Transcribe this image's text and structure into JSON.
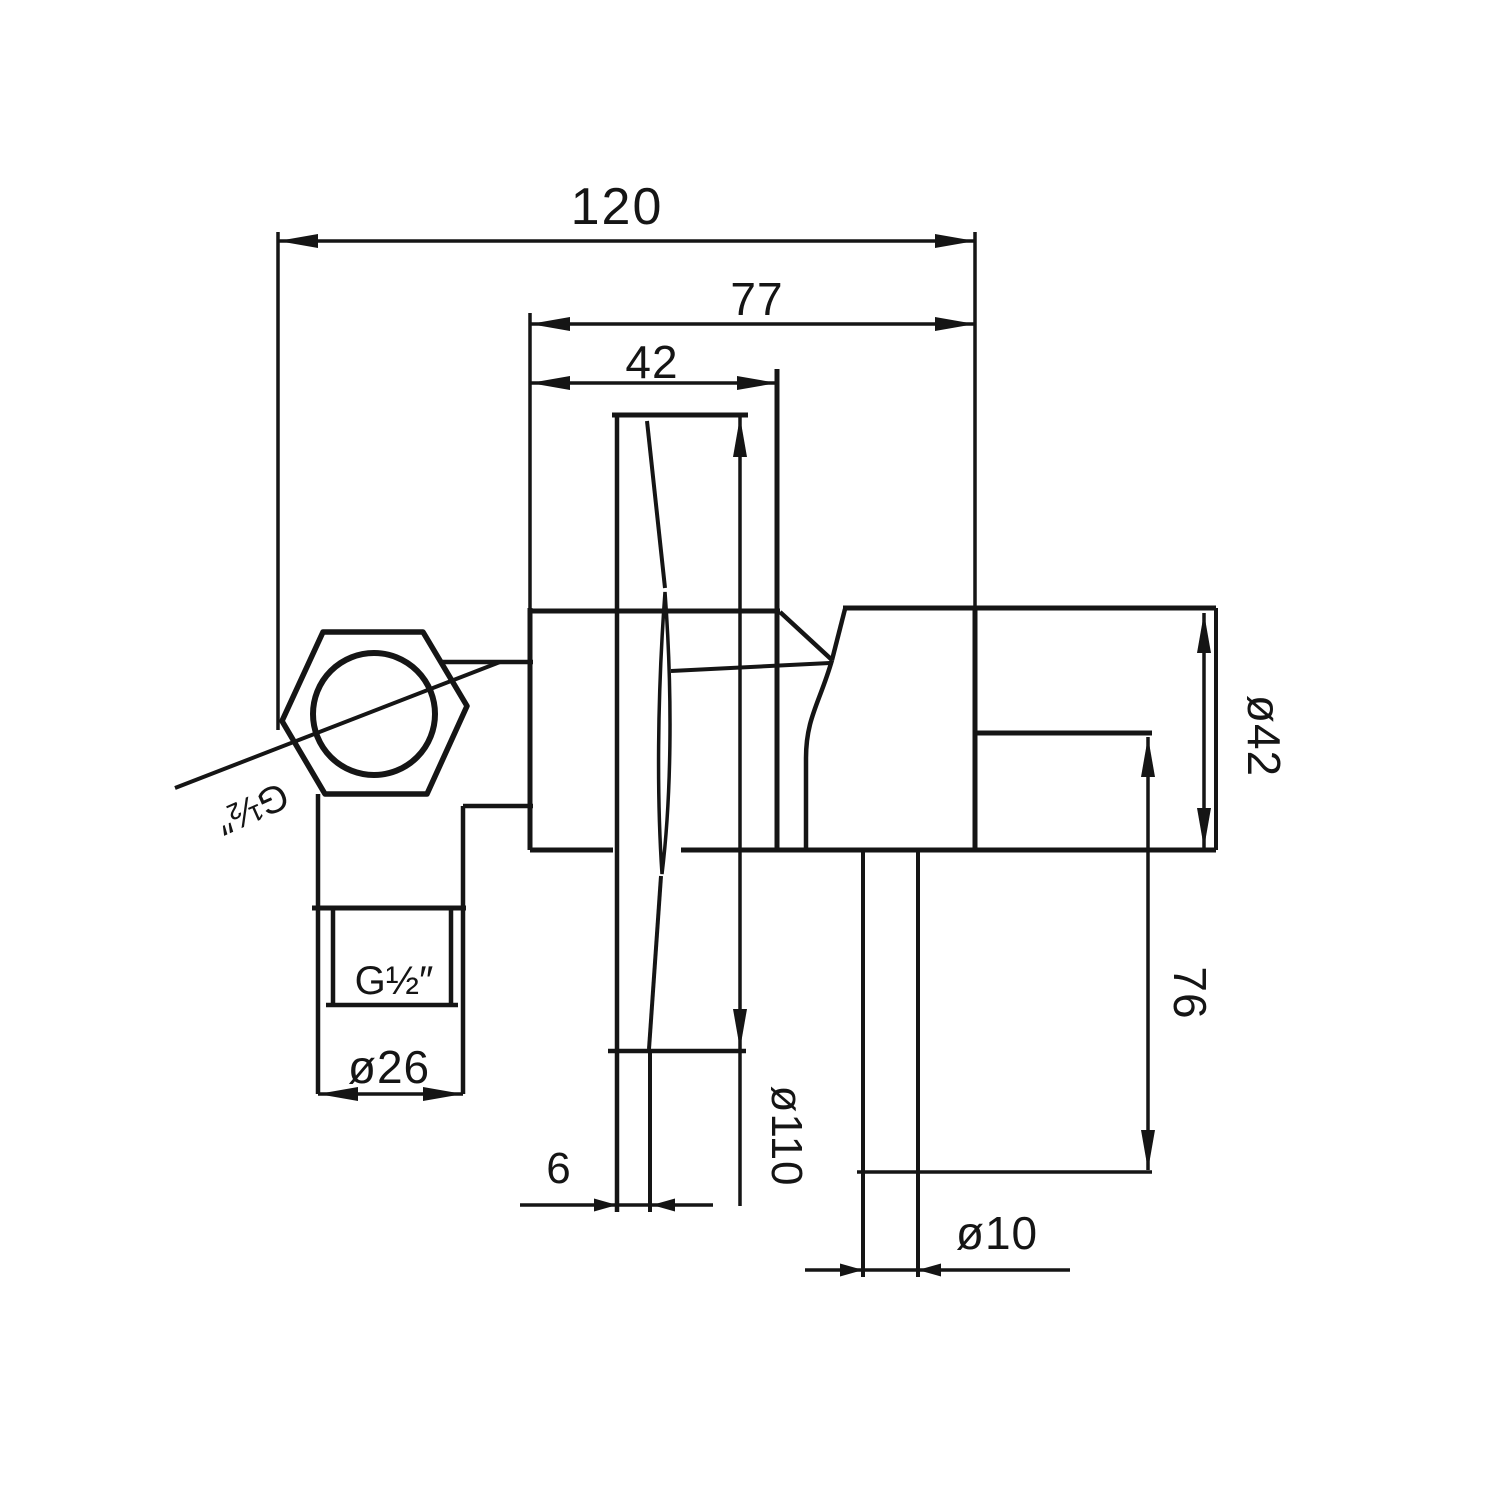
{
  "canvas": {
    "width": 1500,
    "height": 1500,
    "background": "#ffffff",
    "ink": "#151515"
  },
  "drawing": {
    "kind": "technical dimension drawing",
    "subject": "wall-mounted mixer valve, side section with dimensions",
    "labels": {
      "overall_depth": "120",
      "body_depth": "77",
      "plate_depth": "42",
      "spout_diameter": "ø42",
      "spout_to_outlet": "76",
      "plate_diameter": "ø110",
      "inlet_diameter": "ø26",
      "plate_thickness": "6",
      "outlet_diameter": "ø10",
      "inlet_thread": "G½″",
      "supply_thread": "G½″"
    }
  }
}
